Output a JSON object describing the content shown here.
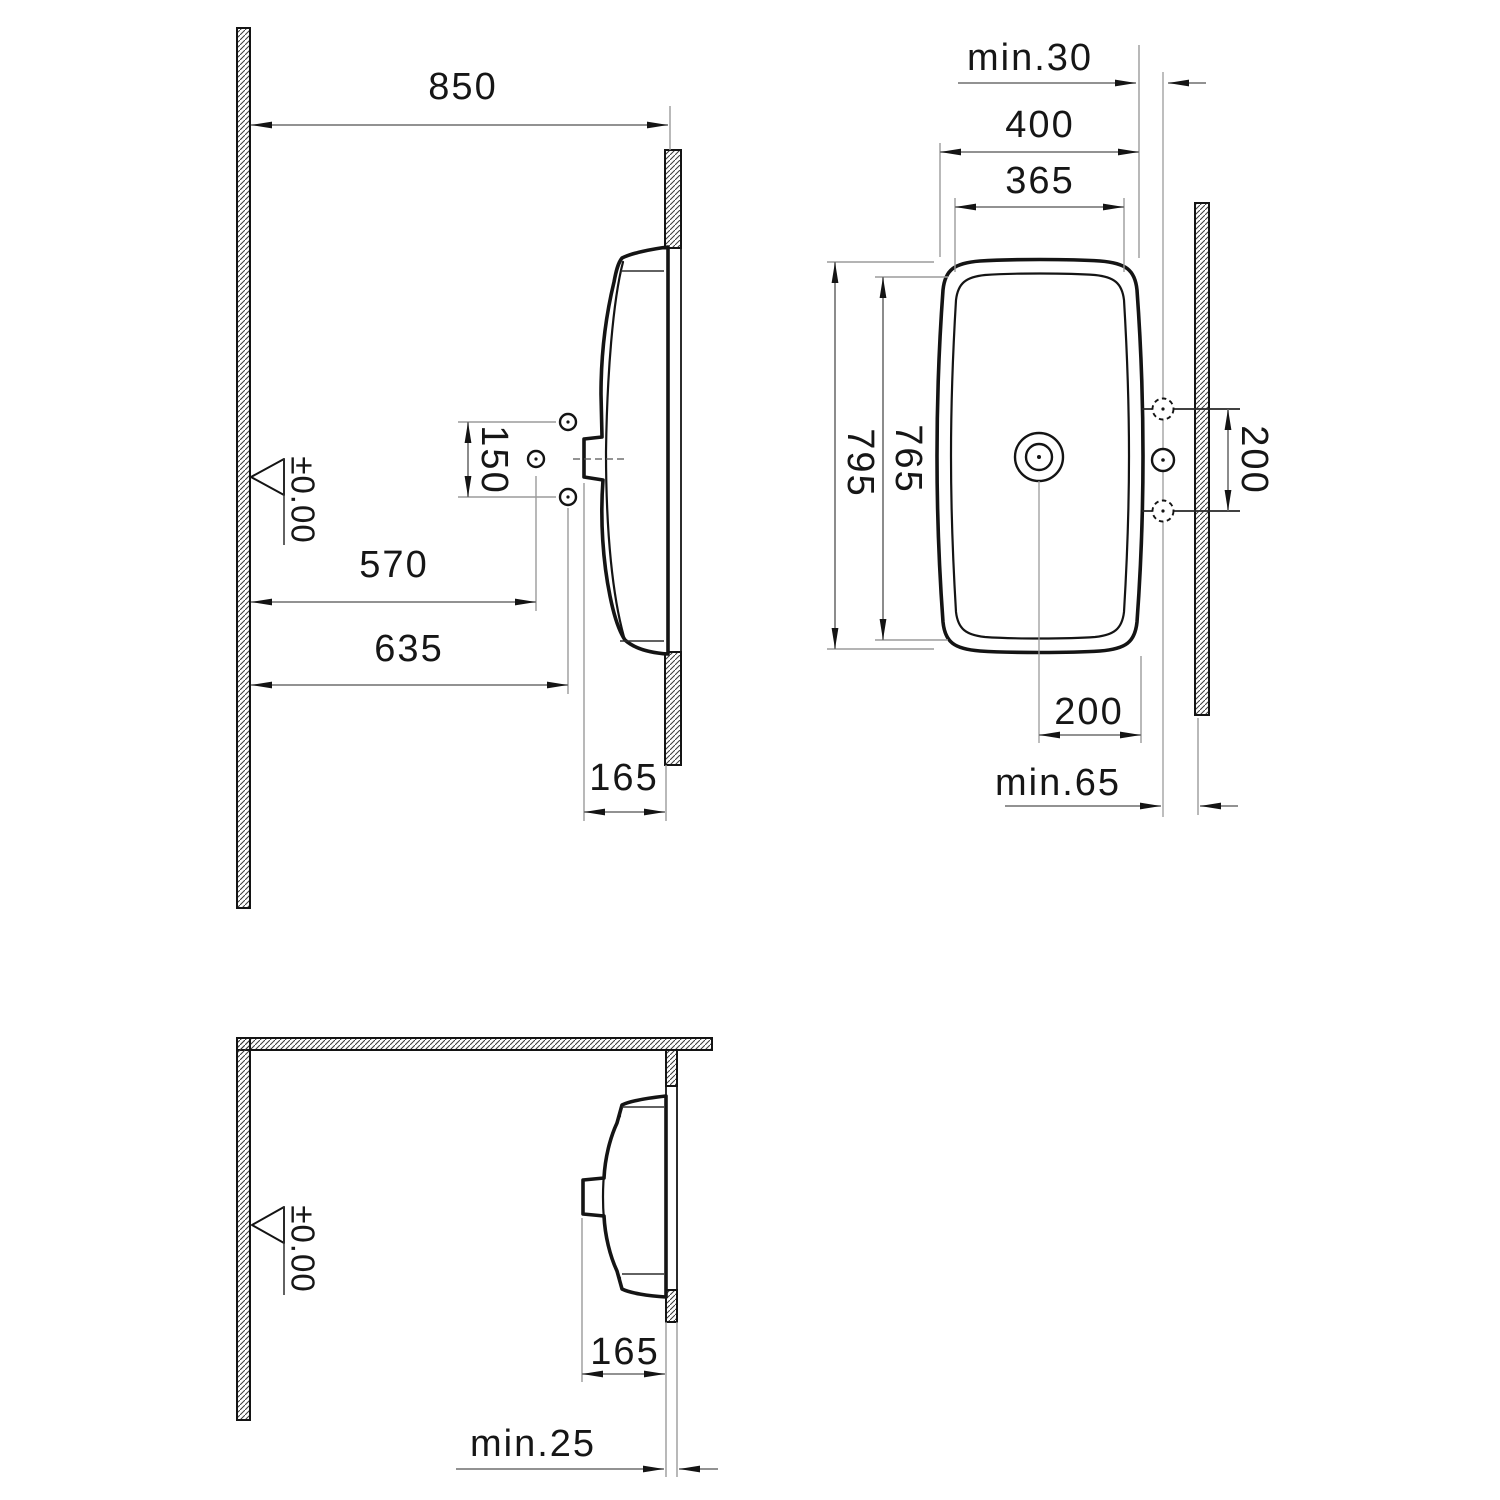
{
  "drawing": {
    "type": "washbasin-installation-technical-drawing",
    "colors": {
      "line": "#141414",
      "dimension": "#6f6f6f",
      "extension": "#9b9b9b",
      "background": "#ffffff"
    },
    "side_view": {
      "dim_wall_distance": "850",
      "dim_hole_spacing": "150",
      "dim_570": "570",
      "dim_635": "635",
      "dim_depth": "165",
      "level_mark": "±0.00"
    },
    "plan_view": {
      "dim_min_gap_top": "min.30",
      "dim_outer_width": "400",
      "dim_inner_width": "365",
      "dim_outer_length": "795",
      "dim_inner_length": "765",
      "dim_taphole_spacing": "200",
      "dim_drain_offset": "200",
      "dim_min_gap_bottom": "min.65"
    },
    "corner_view": {
      "dim_depth": "165",
      "dim_min_gap": "min.25",
      "level_mark": "±0.00"
    }
  }
}
